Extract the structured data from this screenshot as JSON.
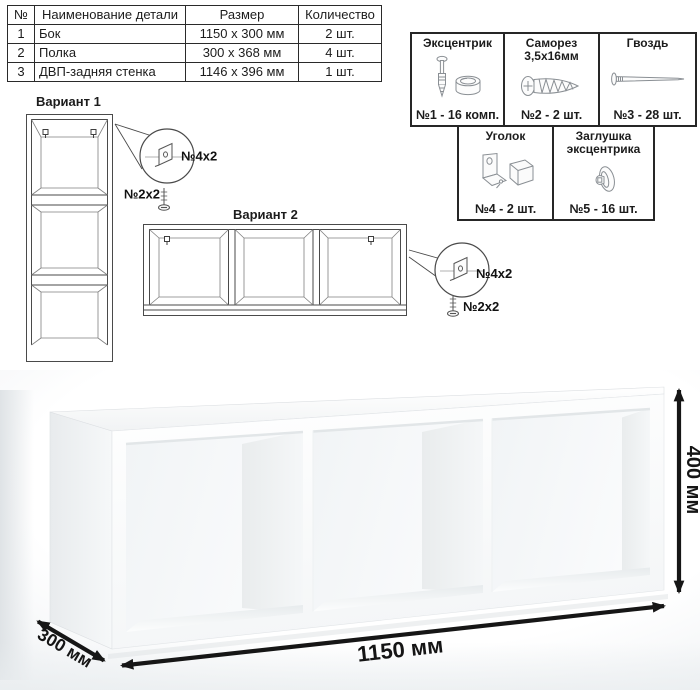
{
  "parts_table": {
    "headers": [
      "№",
      "Наименование детали",
      "Размер",
      "Количество"
    ],
    "rows": [
      {
        "num": "1",
        "name": "Бок",
        "size": "1150 x 300 мм",
        "qty": "2 шт."
      },
      {
        "num": "2",
        "name": "Полка",
        "size": "300 x 368 мм",
        "qty": "4 шт."
      },
      {
        "num": "3",
        "name": "ДВП-задняя стенка",
        "size": "1146 x 396 мм",
        "qty": "1 шт."
      }
    ]
  },
  "hardware_box": {
    "items": [
      {
        "name": "Эксцентрик",
        "qty": "№1 - 16 комп.",
        "icon": "eccentric-cam-icon"
      },
      {
        "name": "Саморез 3,5х16мм",
        "qty": "№2 - 2 шт.",
        "icon": "screw-icon"
      },
      {
        "name": "Гвоздь",
        "qty": "№3 - 28 шт.",
        "icon": "nail-icon"
      },
      {
        "name": "Уголок",
        "qty": "№4 - 2 шт.",
        "icon": "corner-bracket-icon"
      },
      {
        "name": "Заглушка эксцентрика",
        "qty": "№5 - 16 шт.",
        "icon": "eccentric-cap-icon"
      }
    ]
  },
  "variant1": {
    "title": "Вариант 1",
    "bracket_label": "№4х2",
    "screw_label": "№2х2"
  },
  "variant2": {
    "title": "Вариант 2",
    "bracket_label": "№4х2",
    "screw_label": "№2х2"
  },
  "dimensions": {
    "width": "1150 мм",
    "height": "400 мм",
    "depth": "300 мм"
  },
  "colors": {
    "line": "#4a4a4a",
    "arrow": "#161616",
    "panel": "#ffffff",
    "shade": "#eef1f3"
  }
}
